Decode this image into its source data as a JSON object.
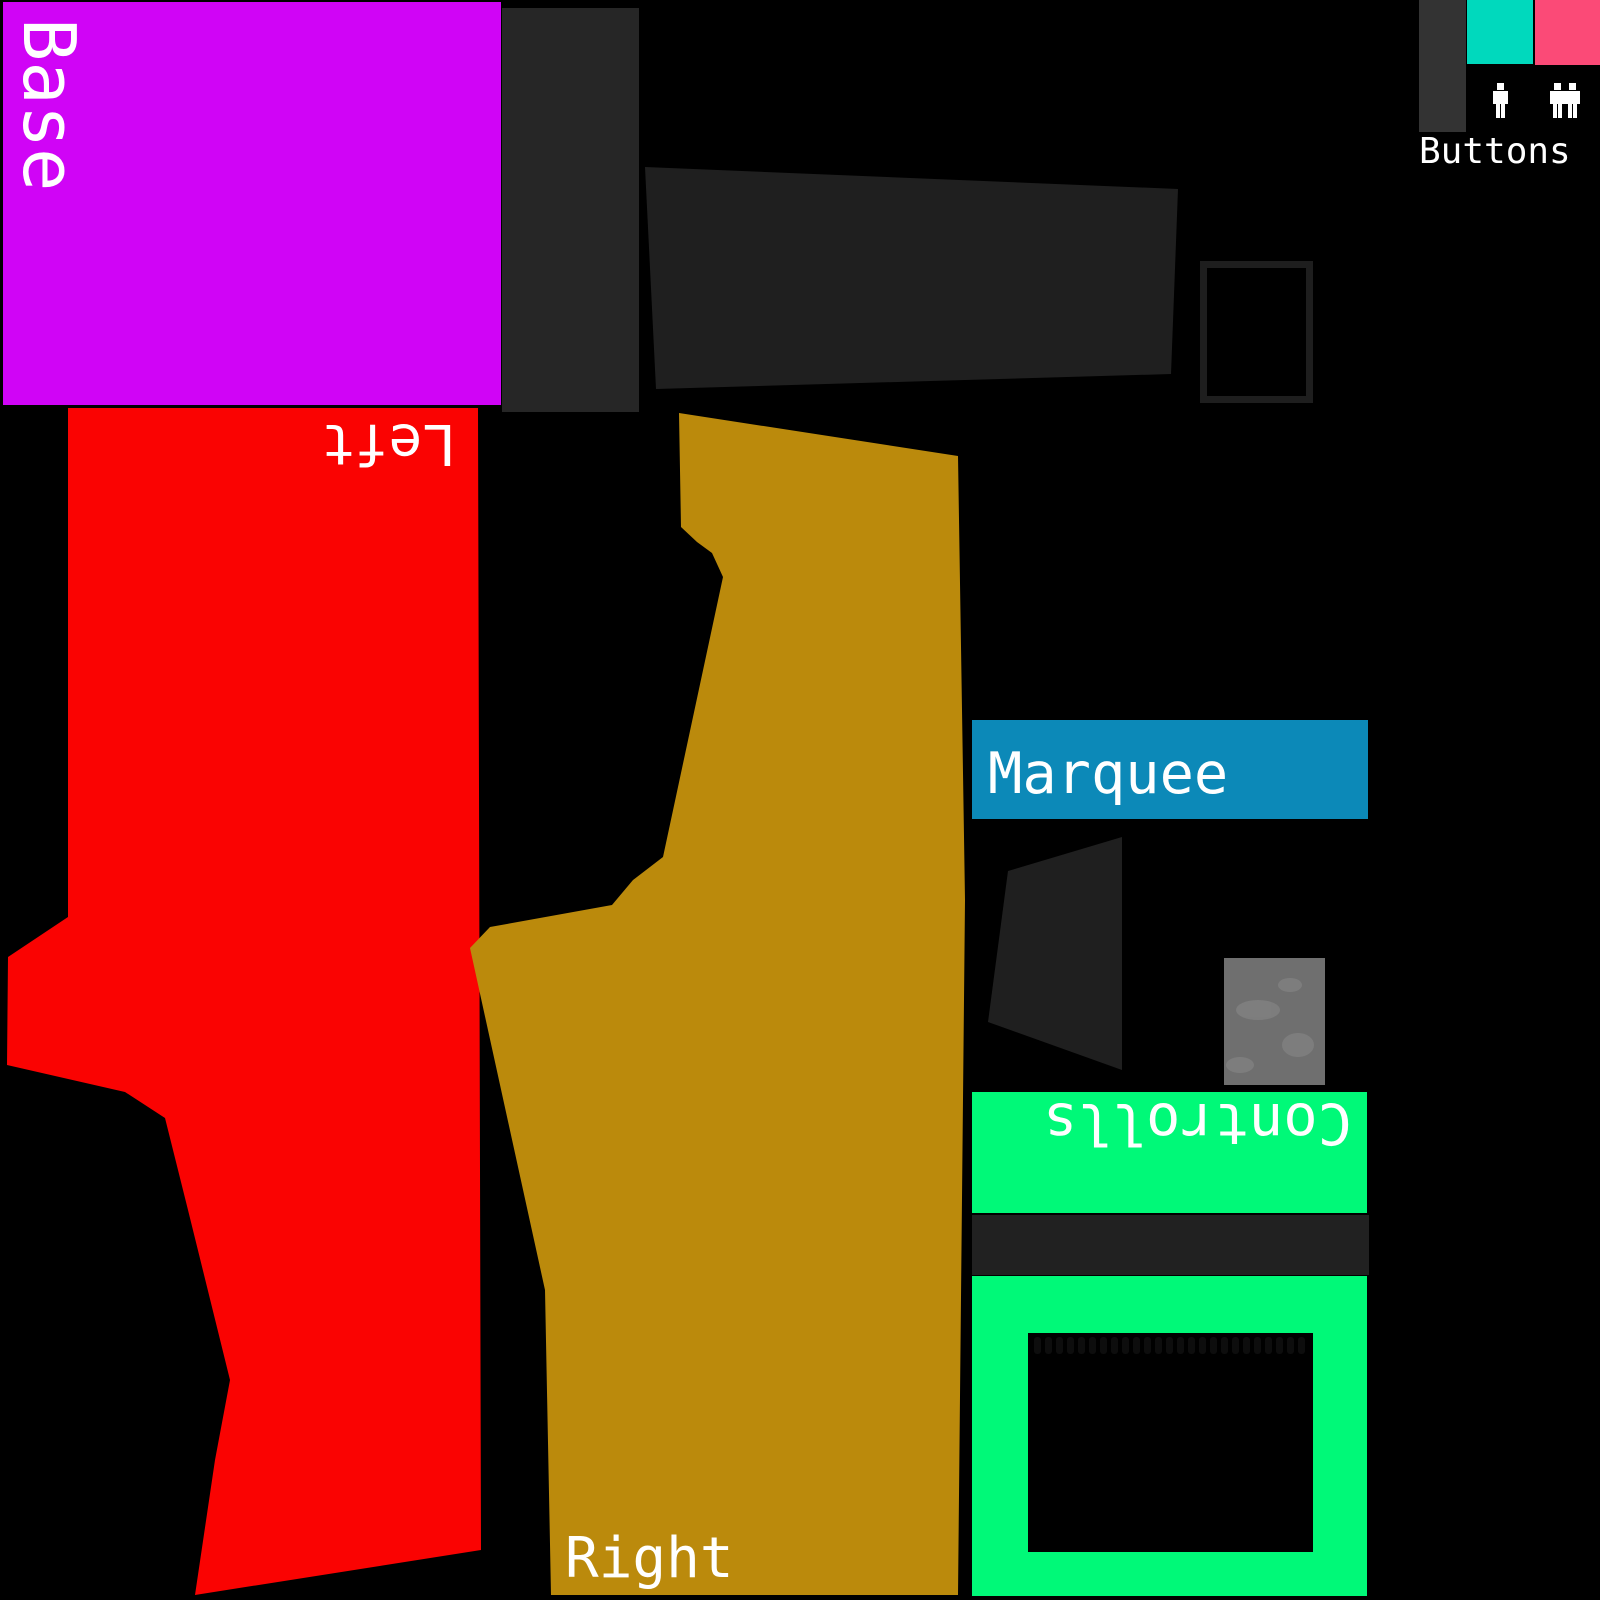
{
  "canvas": {
    "background": "#000000",
    "text_color": "#FFFFFF"
  },
  "regions": {
    "base": {
      "label": "Base",
      "color": "#D004F6"
    },
    "left": {
      "label": "Left",
      "color": "#FA0302"
    },
    "right": {
      "label": "Right",
      "color": "#BB8A0C"
    },
    "marquee": {
      "label": "Marquee",
      "color": "#0C89B8"
    },
    "controlls": {
      "label": "Controlls",
      "color": "#00F978"
    },
    "buttons": {
      "label": "Buttons",
      "icon_color": "#FFFFFF",
      "swatch_dark": "#333333",
      "swatch_teal": "#00D9BD",
      "swatch_pink": "#FB4A77",
      "icons": [
        "one-player-icon",
        "two-players-icon"
      ]
    }
  },
  "panels": {
    "dark_rect": "#262626",
    "dark_quad": "#1F1F1F",
    "frame_outline": "#1E1E1E",
    "divider_strip": "#212121",
    "texture_base": "#6F6F6F",
    "texture_blotch": "#8A8A8A",
    "screen_inset": "#000000",
    "scallop_row": "#0D0D0D"
  }
}
